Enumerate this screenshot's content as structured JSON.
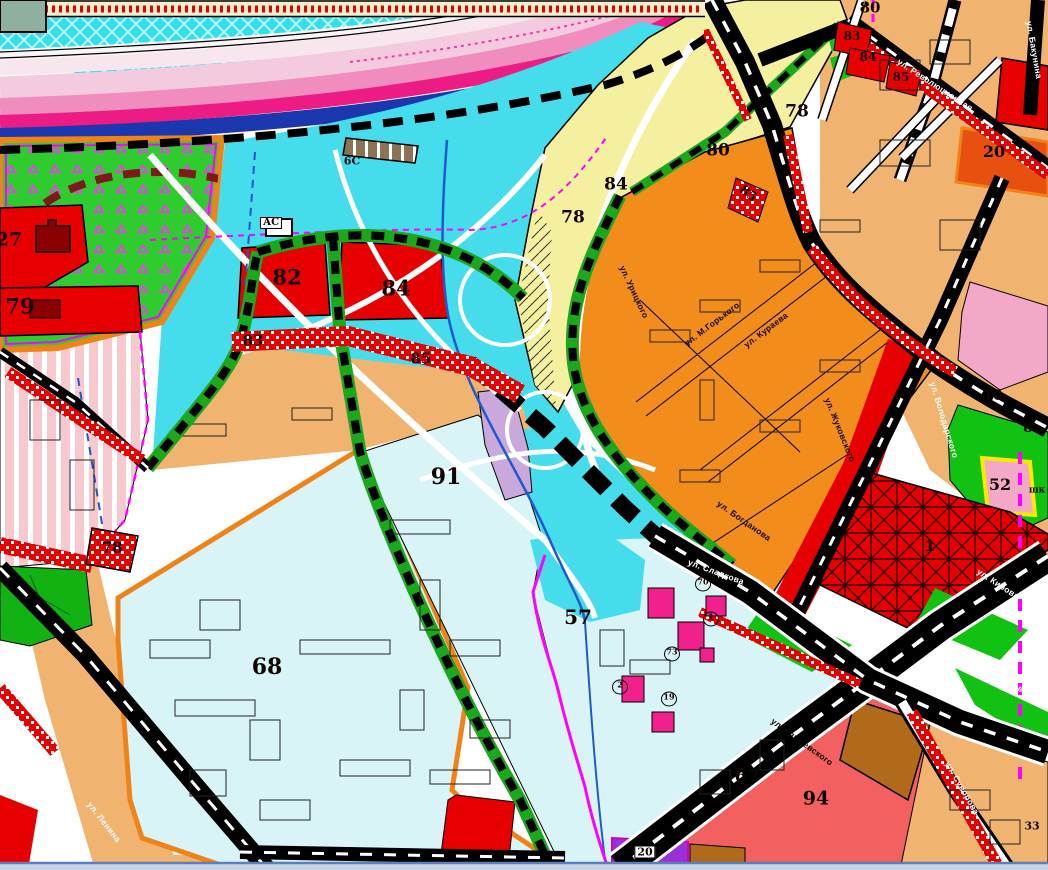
{
  "map": {
    "kind": "city functional zoning map (generplan fragment)",
    "colors": {
      "water_hatch_cyan": "#35DFE9",
      "flood_cyan": "#45DCEC",
      "pale_blue_zone": "#D9F4F6",
      "river_blue": "#1B37AE",
      "pink_pale": "#F4CBDE",
      "pink_mid": "#F08CBE",
      "pink_deep": "#EC1C84",
      "zone_red": "#E60000",
      "zone_orange": "#F28C1A",
      "zone_tan": "#F0B470",
      "zone_yellow": "#F5F0A0",
      "zone_salmon": "#F26060",
      "zone_brown": "#B06A1A",
      "park_green": "#2FCC2F",
      "grass_green": "#12C212",
      "lavender": "#C9A8DC",
      "purple": "#9B30D6",
      "magenta": "#FF00FF",
      "pink_zone": "#F3A8C8",
      "border_orange": "#F08318",
      "cream": "#F4EFCF"
    }
  },
  "labels": {
    "zones": [
      {
        "t": "82",
        "x": 287,
        "y": 277,
        "s": 21
      },
      {
        "t": "84",
        "x": 396,
        "y": 288,
        "s": 21
      },
      {
        "t": "83",
        "x": 253,
        "y": 341,
        "s": 15
      },
      {
        "t": "85",
        "x": 421,
        "y": 359,
        "s": 15
      },
      {
        "t": "79",
        "x": 20,
        "y": 306,
        "s": 21
      },
      {
        "t": "27",
        "x": 9,
        "y": 240,
        "s": 19
      },
      {
        "t": "78",
        "x": 112,
        "y": 548,
        "s": 15
      },
      {
        "t": "68",
        "x": 267,
        "y": 667,
        "s": 22
      },
      {
        "t": "91",
        "x": 446,
        "y": 477,
        "s": 22
      },
      {
        "t": "57",
        "x": 578,
        "y": 617,
        "s": 20
      },
      {
        "t": "67",
        "x": 747,
        "y": 777,
        "s": 18
      },
      {
        "t": "94",
        "x": 816,
        "y": 799,
        "s": 19
      },
      {
        "t": "78",
        "x": 573,
        "y": 218,
        "s": 17
      },
      {
        "t": "84",
        "x": 616,
        "y": 185,
        "s": 17
      },
      {
        "t": "80",
        "x": 718,
        "y": 151,
        "s": 17
      },
      {
        "t": "78",
        "x": 797,
        "y": 112,
        "s": 17
      },
      {
        "t": "80",
        "x": 870,
        "y": 8,
        "s": 15
      },
      {
        "t": "83",
        "x": 852,
        "y": 36,
        "s": 12
      },
      {
        "t": "84",
        "x": 868,
        "y": 57,
        "s": 12
      },
      {
        "t": "85",
        "x": 901,
        "y": 77,
        "s": 12
      },
      {
        "t": "85",
        "x": 748,
        "y": 194,
        "s": 13,
        "r": 38
      },
      {
        "t": "3",
        "x": 1031,
        "y": 90,
        "s": 20
      },
      {
        "t": "20",
        "x": 994,
        "y": 152,
        "s": 16
      },
      {
        "t": "10",
        "x": 993,
        "y": 396,
        "s": 14
      },
      {
        "t": "8",
        "x": 1028,
        "y": 428,
        "s": 14
      },
      {
        "t": "52",
        "x": 1000,
        "y": 485,
        "s": 16
      },
      {
        "t": "1",
        "x": 930,
        "y": 546,
        "s": 16
      },
      {
        "t": "33",
        "x": 1032,
        "y": 826,
        "s": 11
      }
    ],
    "streets": [
      {
        "t": "ул. Кирова",
        "x": 998,
        "y": 584,
        "r": 33,
        "c": "#ffffff"
      },
      {
        "t": "ул. Миронова",
        "x": 1002,
        "y": 676,
        "r": 35,
        "c": "#ffffff"
      },
      {
        "t": "ул. Сладкова",
        "x": 716,
        "y": 572,
        "r": 20,
        "c": "#ffffff"
      },
      {
        "t": "ул. Володарского",
        "x": 944,
        "y": 420,
        "r": 73,
        "c": "#ffffff"
      },
      {
        "t": "ул. Революционная",
        "x": 935,
        "y": 85,
        "r": 33,
        "c": "#ffffff"
      },
      {
        "t": "ул. Бакунина",
        "x": 1034,
        "y": 50,
        "r": 80,
        "c": "#ffffff"
      },
      {
        "t": "ул. Суворова",
        "x": 962,
        "y": 788,
        "r": 60,
        "c": "#ffffff"
      },
      {
        "t": "ул. Ленина",
        "x": 104,
        "y": 822,
        "r": 52,
        "c": "#ffffff"
      },
      {
        "t": "ул. М.Горького",
        "x": 712,
        "y": 324,
        "r": -37,
        "c": "#100500"
      },
      {
        "t": "ул. Кураева",
        "x": 766,
        "y": 330,
        "r": -37,
        "c": "#100500"
      },
      {
        "t": "ул. Урицкого",
        "x": 634,
        "y": 292,
        "r": 65,
        "c": "#100500"
      },
      {
        "t": "ул. Жуковского",
        "x": 840,
        "y": 430,
        "r": 68,
        "c": "#100500"
      },
      {
        "t": "ул. Богданова",
        "x": 744,
        "y": 521,
        "r": 35,
        "c": "#100500"
      },
      {
        "t": "ул. Ключевского",
        "x": 802,
        "y": 742,
        "r": 36,
        "c": "#100500"
      }
    ],
    "special": [
      {
        "t": "6С",
        "x": 352,
        "y": 161,
        "s": 11
      },
      {
        "t": "АС",
        "x": 271,
        "y": 223,
        "s": 10,
        "box": true
      },
      {
        "t": "шк",
        "x": 1037,
        "y": 491,
        "s": 9
      },
      {
        "t": "20",
        "x": 645,
        "y": 852,
        "s": 11,
        "box": true
      }
    ],
    "circled": [
      {
        "t": "70",
        "x": 703,
        "y": 584
      },
      {
        "t": "1",
        "x": 711,
        "y": 619
      },
      {
        "t": "73",
        "x": 672,
        "y": 654
      },
      {
        "t": "2",
        "x": 620,
        "y": 687
      },
      {
        "t": "19",
        "x": 669,
        "y": 699
      }
    ]
  }
}
